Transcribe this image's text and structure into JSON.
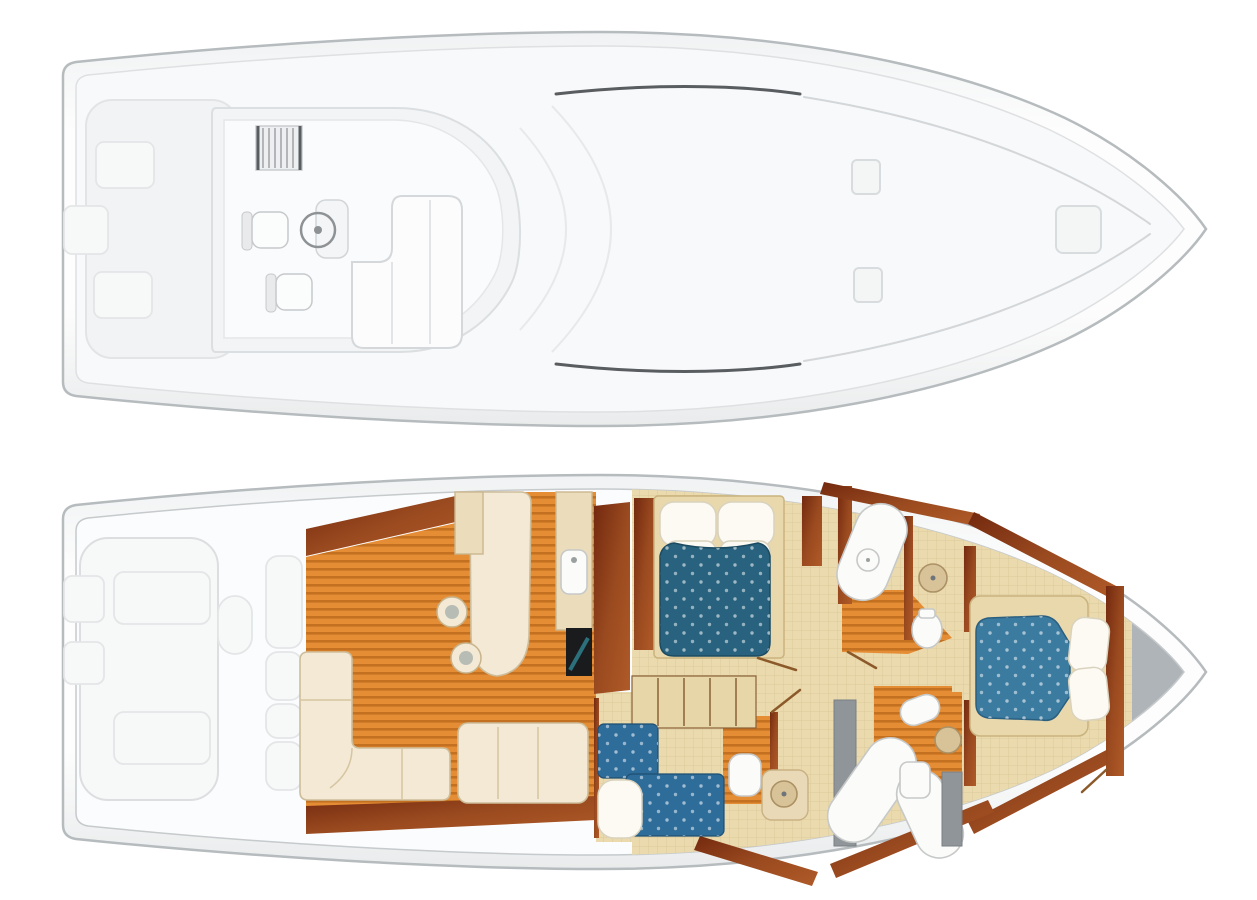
{
  "title": "Sportfish Yacht Deck Plans — Flybridge and Accommodation Layout",
  "colors": {
    "hull_line": "#b6bbbe",
    "deck_fill": "#f2f4f5",
    "deck_shape_line": "#dcdfe1",
    "swoosh": "#595d60",
    "interior_gray": "#aeb4b8",
    "teak": "#e58d35",
    "teak_stripe": "#c06e1e",
    "wood_dark": "#73290f",
    "wood_mid": "#9a4a1f",
    "wood_light": "#b05a28",
    "cream": "#f3e9d4",
    "cream_line": "#cdbd9a",
    "counter": "#ebdcbc",
    "carpet": "#eadaae",
    "master_blue": "#28627e",
    "berth_blue": "#2e6c9a",
    "bow_blue": "#3c7ba0",
    "fixture_white": "#fbfbf9",
    "fixture_line": "#c6c9c8",
    "sink_beige": "#d8c298",
    "sink_line": "#ab9164",
    "shower_gray": "#8f9598",
    "stair_line": "#8a6038",
    "door_wood": "#8c5a2a",
    "appliance": "#191b1d"
  },
  "decks": {
    "flybridge": {
      "label": "Flybridge and deck plan (top view)",
      "items": [
        "cockpit hatches",
        "ladder",
        "port helm seat",
        "starboard helm seat",
        "steering wheel",
        "helm console",
        "L-shaped flybridge seating",
        "foredeck hatch port",
        "foredeck hatch center",
        "foredeck hatch starboard"
      ]
    },
    "lower": {
      "label": "Accommodation deck plan (interior layout)",
      "rooms": [
        "cockpit with fish boxes",
        "mezzanine steps",
        "salon with L-shaped sofa and settee",
        "dinette with stools",
        "galley with cooktop",
        "companionway stairs",
        "master stateroom with queen berth",
        "guest cabin with twin berths",
        "forward stateroom with island berth",
        "heads with showers and sinks"
      ]
    }
  }
}
